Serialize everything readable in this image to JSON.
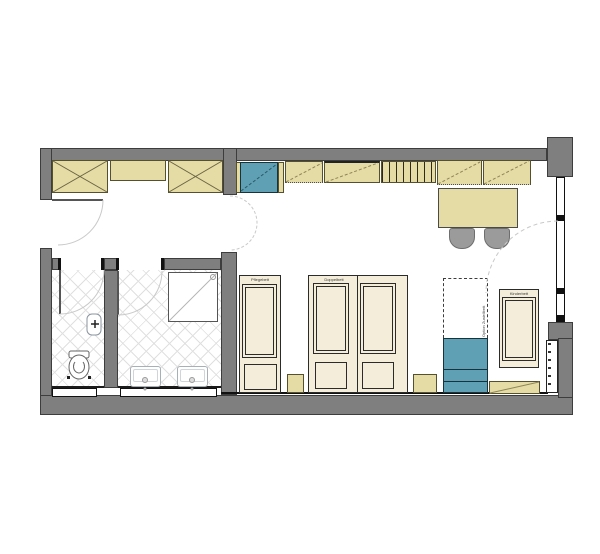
{
  "labels": {
    "bed_single": "Pflegebett",
    "bed_double": "Doppelbett",
    "bed_small": "Kinderbett",
    "bed_option": "Option Zustellbett"
  },
  "colors": {
    "wall": "#7f7f7f",
    "wood": "#e5dba4",
    "woodline": "#55502e",
    "blue": "#5fa0b4",
    "bed": "#f3edda",
    "chair": "#9b9b9b"
  }
}
